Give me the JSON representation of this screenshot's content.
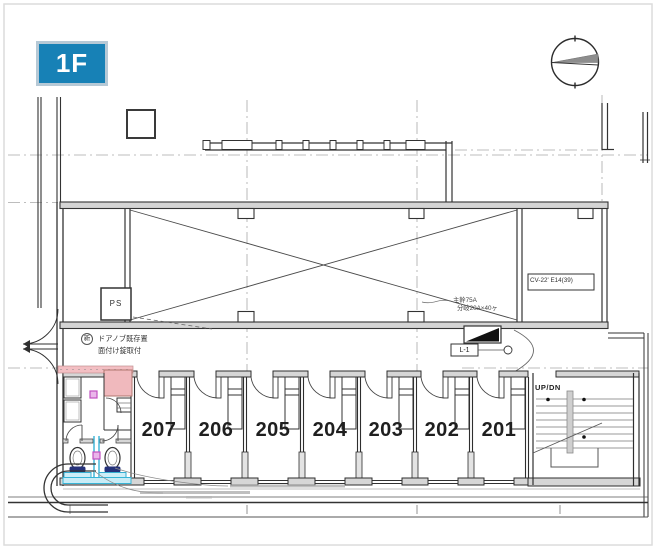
{
  "floor_badge": {
    "label": "1F"
  },
  "rooms": [
    {
      "number": "207"
    },
    {
      "number": "206"
    },
    {
      "number": "205"
    },
    {
      "number": "204"
    },
    {
      "number": "203"
    },
    {
      "number": "202"
    },
    {
      "number": "201"
    }
  ],
  "labels": {
    "pipe_shaft": "PS",
    "stair_direction": "UP/DN",
    "cable_spec": "CV-22' E14(39)",
    "panel_tag": "L-1",
    "breaker_line1": "主幹75A",
    "breaker_line2": "分岐20A×40ヶ",
    "door_note_badge": "新",
    "door_note_line1": "ドアノブ既存置",
    "door_note_line2": "面付け錠取付"
  },
  "icons": {
    "north_arrow": "compass-circle-with-needle"
  },
  "colors": {
    "accent_blue": "#1781b6",
    "badge_border": "#b6c9d6",
    "wall_gray": "#d4d4d4",
    "highlight_pink": "#f2bcc0",
    "fixture_cyan": "#36b5d7",
    "toilet_navy": "#26327a",
    "magenta_marker": "#c050c0",
    "line_dark": "#2f2f2f"
  }
}
